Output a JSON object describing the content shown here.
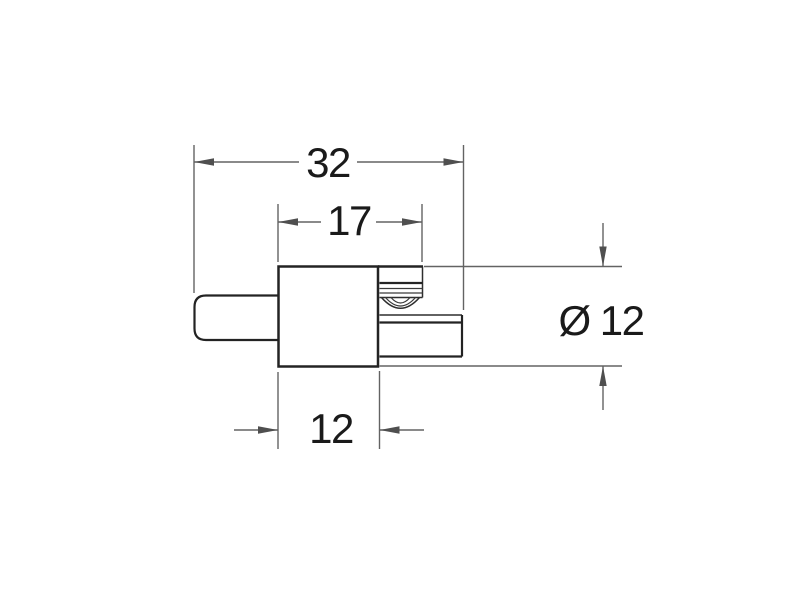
{
  "drawing": {
    "view": "side-profile-technical-drawing",
    "background_color": "#ffffff",
    "part_outline_color": "#232323",
    "dimension_line_color": "#636363",
    "arrow_color": "#4f4f4f",
    "text_color": "#1a1a1a",
    "dimensions": [
      {
        "name": "overall-length",
        "label": "32"
      },
      {
        "name": "body-and-clip-length",
        "label": "17"
      },
      {
        "name": "body-length",
        "label": "12"
      },
      {
        "name": "diameter",
        "label": "Ø 12"
      }
    ]
  }
}
